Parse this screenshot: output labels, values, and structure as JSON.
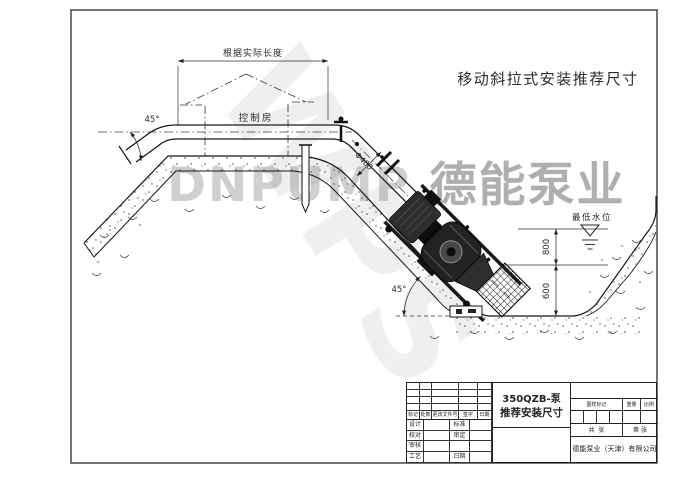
{
  "sheet_title": "移动斜拉式安装推荐尺寸",
  "watermarks": {
    "wps": "WPS",
    "brand_latin": "DNPUMP",
    "brand_cjk": "德能泵业"
  },
  "annotations": {
    "length_note": "根据实际长度",
    "control_room": "控制房",
    "bend_angle": "45°",
    "slope_angle": "45°",
    "pipe_diameter": "Φ400",
    "lowest_water_level": "最低水位",
    "dim_submergence": "800",
    "dim_clearance": "600"
  },
  "title_block": {
    "product_model": "350QZB-泵",
    "drawing_name": "推荐安装尺寸",
    "company": "德能泵业（天津）有限公司",
    "revision_columns": [
      "标记",
      "处数",
      "更改文件号",
      "签字",
      "日期"
    ],
    "signature_rows": [
      {
        "left": "设计",
        "right": "标准"
      },
      {
        "left": "校对",
        "right": "审定"
      },
      {
        "left": "审核",
        "right": ""
      },
      {
        "left": "工艺",
        "right": "日期"
      }
    ],
    "info_columns": [
      "图样标记",
      "重量",
      "比例"
    ],
    "sheet_total": "共  张",
    "sheet_no": "第  张"
  }
}
